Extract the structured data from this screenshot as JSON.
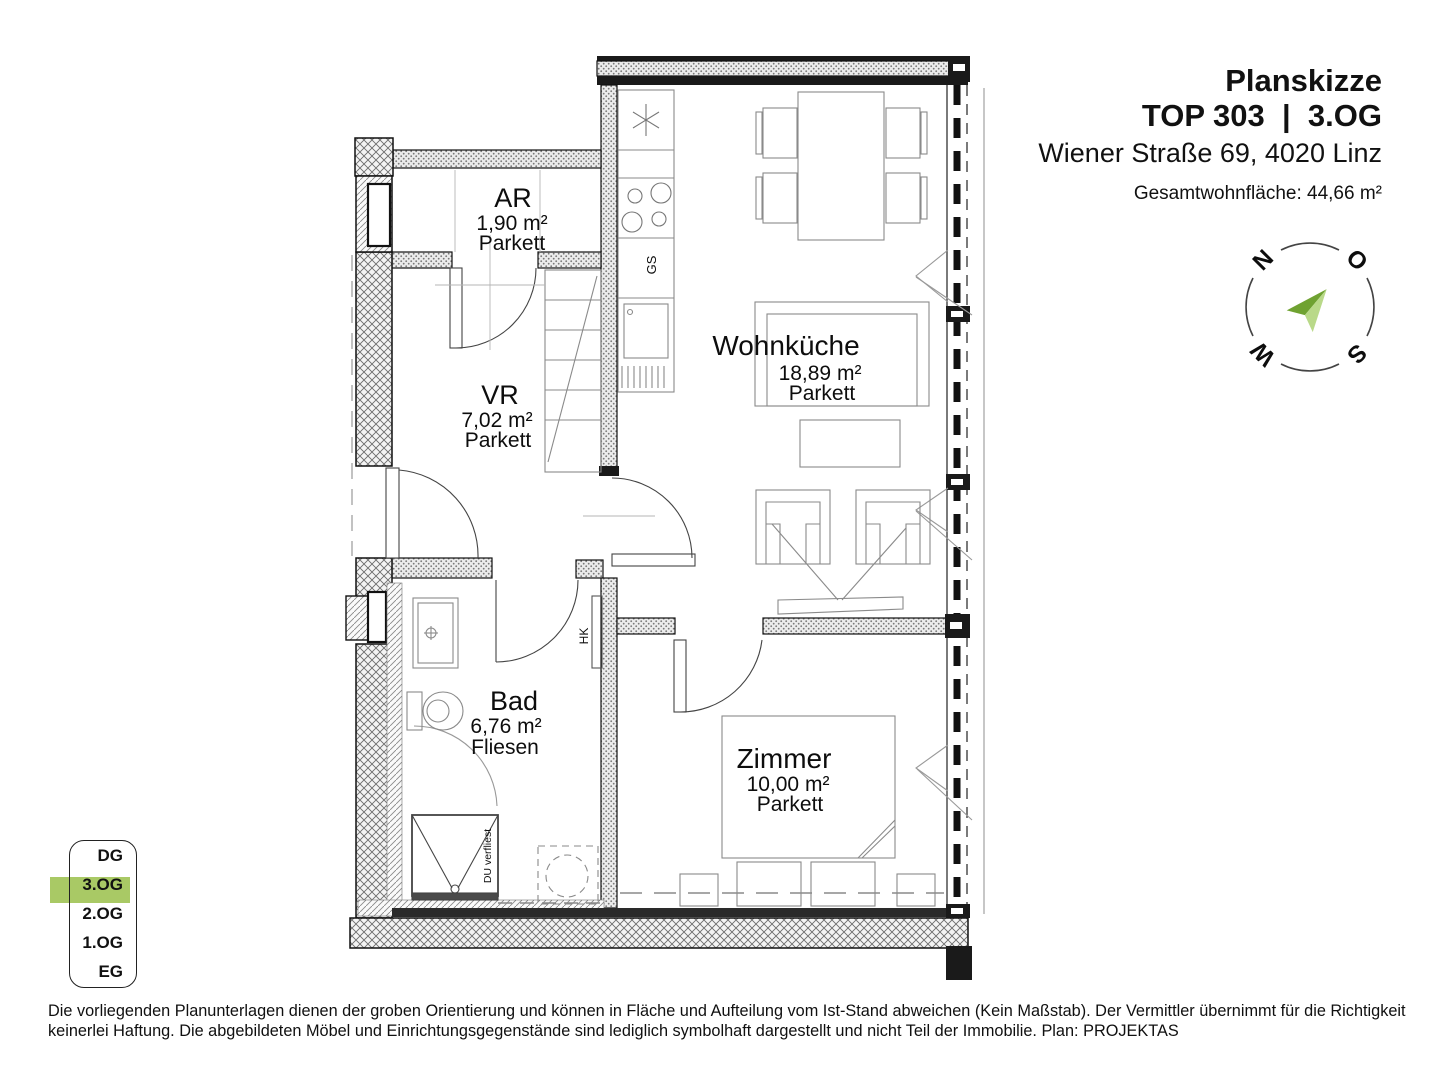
{
  "header": {
    "title": "Planskizze",
    "unit_line": "TOP 303  |  3.OG",
    "address": "Wiener Straße 69, 4020 Linz",
    "total_area": "Gesamtwohnfläche: 44,66 m²"
  },
  "compass": {
    "letters": {
      "n": "N",
      "o": "O",
      "s": "S",
      "w": "W"
    }
  },
  "floor_selector": {
    "active_color": "#a9c965",
    "floors": [
      {
        "label": "DG",
        "active": false
      },
      {
        "label": "3.OG",
        "active": true
      },
      {
        "label": "2.OG",
        "active": false
      },
      {
        "label": "1.OG",
        "active": false
      },
      {
        "label": "EG",
        "active": false
      }
    ]
  },
  "plan": {
    "rooms": [
      {
        "name": "AR",
        "area": "1,90 m²",
        "floor": "Parkett"
      },
      {
        "name": "VR",
        "area": "7,02 m²",
        "floor": "Parkett"
      },
      {
        "name": "Wohnküche",
        "area": "18,89 m²",
        "floor": "Parkett"
      },
      {
        "name": "Bad",
        "area": "6,76 m²",
        "floor": "Fliesen"
      },
      {
        "name": "Zimmer",
        "area": "10,00 m²",
        "floor": "Parkett"
      }
    ],
    "annotations": {
      "dishwasher": "GS",
      "radiator": "HK",
      "shower": "DU verfliest"
    }
  },
  "colors": {
    "highlight_green": "#a9c965",
    "arrow_dark": "#6fa231",
    "arrow_light": "#b9d989"
  },
  "disclaimer": {
    "line1": "Die vorliegenden Planunterlagen dienen der groben Orientierung und können in Fläche und Aufteilung vom Ist-Stand abweichen (Kein Maßstab). Der Vermittler übernimmt für die Richtigkeit",
    "line2": "keinerlei Haftung. Die abgebildeten Möbel und Einrichtungsgegenstände sind lediglich symbolhaft dargestellt und nicht Teil der Immobilie. Plan: PROJEKTAS"
  }
}
